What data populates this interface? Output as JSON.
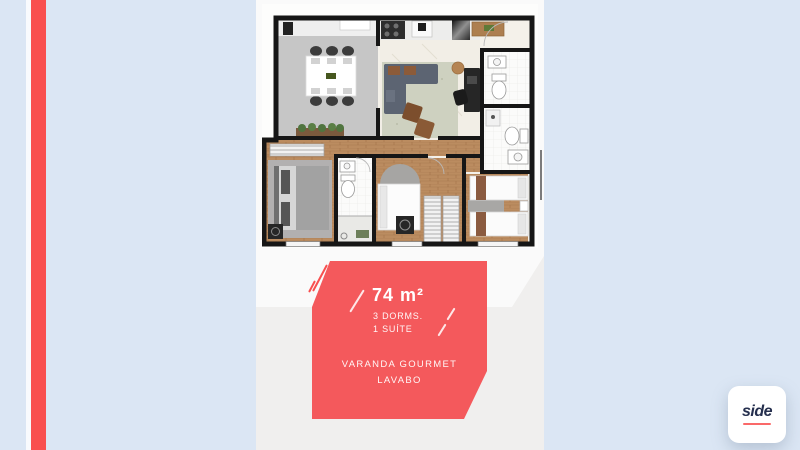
{
  "colors": {
    "background": "#dbe6f4",
    "accent": "#f94f4f",
    "badge": "#f4595c",
    "panel": "#fafafa",
    "panelShade": "#f0efee",
    "logoNavy": "#252f4e",
    "tick": "#7b7b7b"
  },
  "badge": {
    "area": "74 m²",
    "dorms": "3 DORMS.",
    "suite": "1 SUÍTE",
    "feature1": "VARANDA GOURMET",
    "feature2": "LAVABO"
  },
  "logo": {
    "name": "side"
  }
}
